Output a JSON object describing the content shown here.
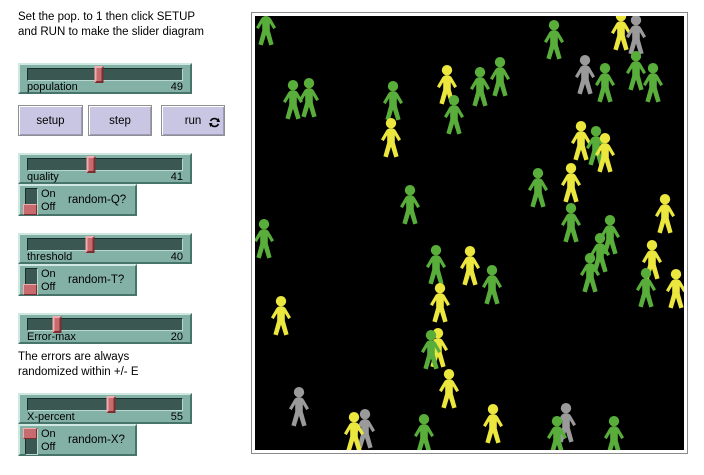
{
  "notes": {
    "top": "Set the pop. to 1 then click SETUP\nand RUN to make the slider diagram",
    "middle": "The errors are always\nrandomized within +/- E"
  },
  "buttons": {
    "setup": "setup",
    "step": "step",
    "run": "run",
    "forever_icon": "repeat-arrows"
  },
  "sliders": [
    {
      "label": "population",
      "value": "49",
      "percent": 46
    },
    {
      "label": "quality",
      "value": "41",
      "percent": 41
    },
    {
      "label": "threshold",
      "value": "40",
      "percent": 40
    },
    {
      "label": "Error-max",
      "value": "20",
      "percent": 19
    },
    {
      "label": "X-percent",
      "value": "55",
      "percent": 54
    }
  ],
  "switches": [
    {
      "label": "random-Q?",
      "on": "On",
      "off": "Off",
      "state": "off"
    },
    {
      "label": "random-T?",
      "on": "On",
      "off": "Off",
      "state": "off"
    },
    {
      "label": "random-X?",
      "on": "On",
      "off": "Off",
      "state": "on"
    }
  ],
  "canvas": {
    "background": "#000000",
    "colors": {
      "green": "#59ae3b",
      "yellow": "#ece73f",
      "gray": "#9a9a9a"
    },
    "figures": [
      {
        "c": "green",
        "x": -1,
        "y": -10
      },
      {
        "c": "green",
        "x": 42,
        "y": 62
      },
      {
        "c": "green",
        "x": 26,
        "y": 64
      },
      {
        "c": "green",
        "x": 126,
        "y": 65
      },
      {
        "c": "yellow",
        "x": 124,
        "y": 102
      },
      {
        "c": "yellow",
        "x": 180,
        "y": 49
      },
      {
        "c": "green",
        "x": 187,
        "y": 79
      },
      {
        "c": "green",
        "x": 233,
        "y": 41
      },
      {
        "c": "green",
        "x": 213,
        "y": 51
      },
      {
        "c": "green",
        "x": 287,
        "y": 4
      },
      {
        "c": "yellow",
        "x": 354,
        "y": -5
      },
      {
        "c": "gray",
        "x": 369,
        "y": -1
      },
      {
        "c": "gray",
        "x": 318,
        "y": 39
      },
      {
        "c": "green",
        "x": 338,
        "y": 47
      },
      {
        "c": "green",
        "x": 369,
        "y": 35
      },
      {
        "c": "green",
        "x": 386,
        "y": 47
      },
      {
        "c": "yellow",
        "x": 314,
        "y": 105
      },
      {
        "c": "green",
        "x": 329,
        "y": 110
      },
      {
        "c": "yellow",
        "x": 338,
        "y": 117
      },
      {
        "c": "green",
        "x": 271,
        "y": 152
      },
      {
        "c": "yellow",
        "x": 304,
        "y": 147
      },
      {
        "c": "green",
        "x": 304,
        "y": 187
      },
      {
        "c": "green",
        "x": 343,
        "y": 199
      },
      {
        "c": "green",
        "x": 333,
        "y": 217
      },
      {
        "c": "green",
        "x": 323,
        "y": 237
      },
      {
        "c": "yellow",
        "x": 398,
        "y": 178
      },
      {
        "c": "yellow",
        "x": 385,
        "y": 224
      },
      {
        "c": "green",
        "x": 379,
        "y": 252
      },
      {
        "c": "yellow",
        "x": 409,
        "y": 253
      },
      {
        "c": "yellow",
        "x": 203,
        "y": 230
      },
      {
        "c": "green",
        "x": 225,
        "y": 249
      },
      {
        "c": "green",
        "x": 143,
        "y": 169
      },
      {
        "c": "green",
        "x": 169,
        "y": 229
      },
      {
        "c": "yellow",
        "x": 173,
        "y": 267
      },
      {
        "c": "green",
        "x": -3,
        "y": 203
      },
      {
        "c": "yellow",
        "x": 14,
        "y": 280
      },
      {
        "c": "gray",
        "x": 32,
        "y": 371
      },
      {
        "c": "gray",
        "x": 98,
        "y": 393
      },
      {
        "c": "yellow",
        "x": 87,
        "y": 396
      },
      {
        "c": "green",
        "x": 157,
        "y": 398
      },
      {
        "c": "yellow",
        "x": 171,
        "y": 312
      },
      {
        "c": "green",
        "x": 164,
        "y": 314
      },
      {
        "c": "yellow",
        "x": 182,
        "y": 353
      },
      {
        "c": "yellow",
        "x": 226,
        "y": 388
      },
      {
        "c": "gray",
        "x": 299,
        "y": 387
      },
      {
        "c": "green",
        "x": 290,
        "y": 400
      },
      {
        "c": "green",
        "x": 347,
        "y": 400
      }
    ]
  }
}
